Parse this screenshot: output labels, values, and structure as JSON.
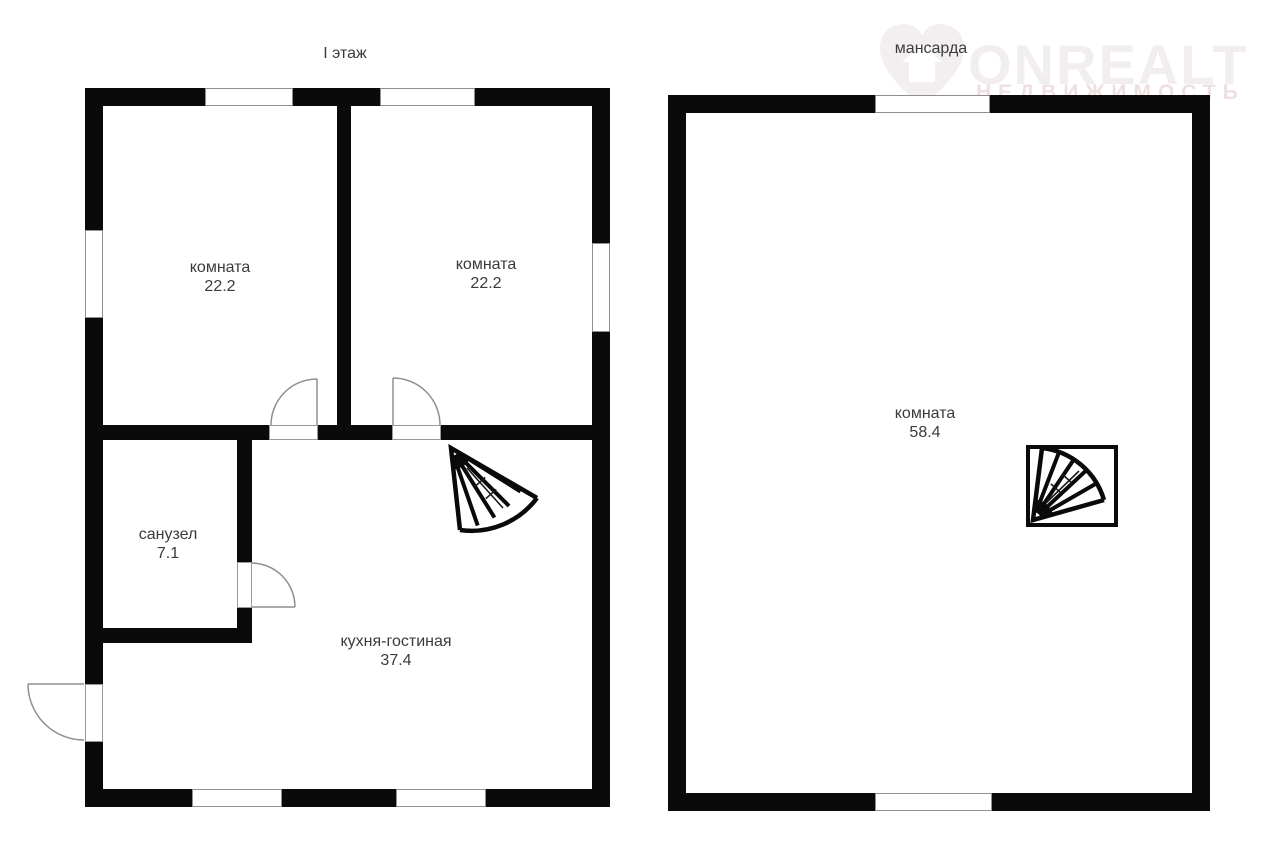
{
  "watermark": {
    "brand": "ONREALT",
    "tagline": "НЕДВИЖИМОСТЬ",
    "icon": "heart-house-logo-icon",
    "brand_color": "#f2eef0",
    "tagline_color": "#eee0e1"
  },
  "floors": [
    {
      "title": "I этаж",
      "rooms": [
        {
          "name": "комната",
          "area": "22.2"
        },
        {
          "name": "комната",
          "area": "22.2"
        },
        {
          "name": "санузел",
          "area": "7.1"
        },
        {
          "name": "кухня-гостиная",
          "area": "37.4"
        }
      ]
    },
    {
      "title": "мансарда",
      "rooms": [
        {
          "name": "комната",
          "area": "58.4"
        }
      ]
    }
  ],
  "icons": {
    "stairs_first_floor": "winder-staircase-icon",
    "stairs_attic": "winder-staircase-boxed-icon",
    "doors": "door-swing-arc-icon"
  },
  "colors": {
    "background": "#ffffff",
    "wall": "#0a0a0a",
    "door_arc": "#8f8f8f",
    "label_text": "#3b3b3b"
  }
}
